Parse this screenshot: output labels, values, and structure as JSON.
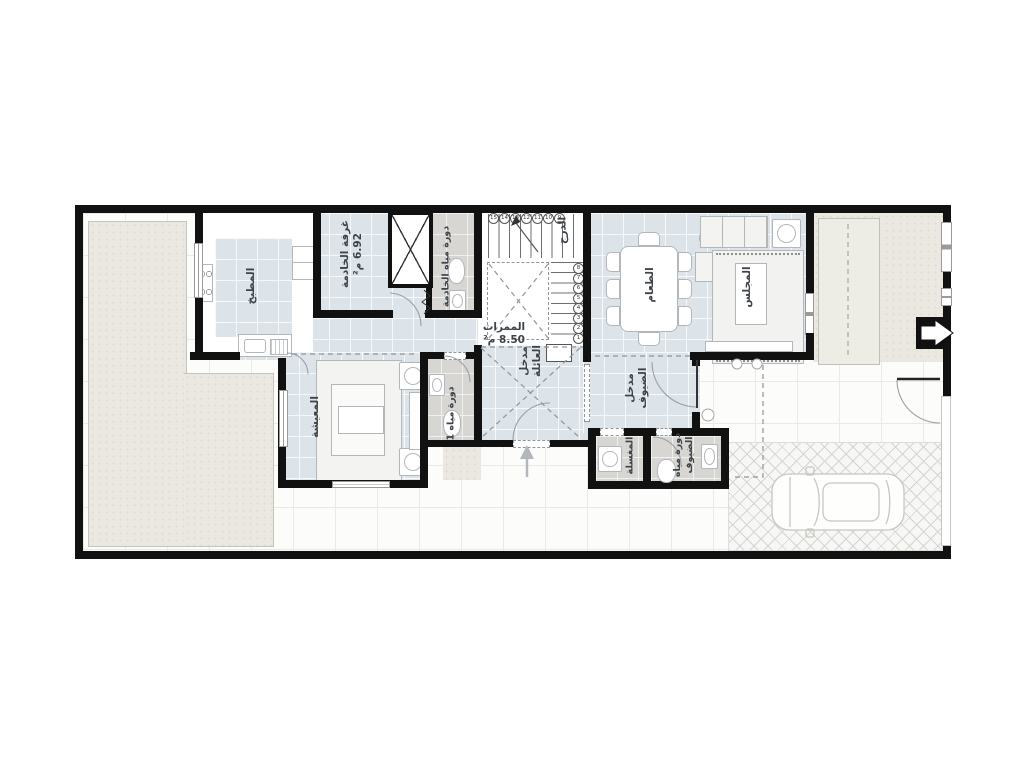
{
  "plan": {
    "type": "residential-ground-floor-plan",
    "orientation": "landscape",
    "colors": {
      "wall": "#111111",
      "room_floor": "#dce3e9",
      "wet_floor": "#d7d6d2",
      "yard": "#eae8e1",
      "paving": "#f7f7f5",
      "label_text": "#3e4349"
    },
    "rooms": {
      "kitchen": {
        "label": "المطبخ"
      },
      "maid_room": {
        "label": "غرفة الخادمة",
        "area": "6.92 م²"
      },
      "maid_bath": {
        "label": "دورة مياه الخادمة"
      },
      "stairs": {
        "label": "الدرج"
      },
      "corridors": {
        "label": "الممرات",
        "area": "8.50 م²"
      },
      "dining": {
        "label": "الطعام"
      },
      "majlis": {
        "label": "المجلس"
      },
      "living": {
        "label": "المعيشة"
      },
      "bath1": {
        "label": "دورة مياه 1"
      },
      "family_entrance": {
        "label": "مدخل العائلة"
      },
      "guest_entrance": {
        "label": "مدخل الضيوف"
      },
      "washbasin": {
        "label": "المغسلة"
      },
      "guest_bath": {
        "label": "دورة مياه الضيوف"
      }
    },
    "stairs": {
      "top_numbers": [
        "15",
        "14",
        "13",
        "12",
        "11",
        "10",
        "9"
      ],
      "side_numbers": [
        "8",
        "7",
        "6",
        "5",
        "4",
        "3",
        "2",
        "1"
      ]
    }
  }
}
